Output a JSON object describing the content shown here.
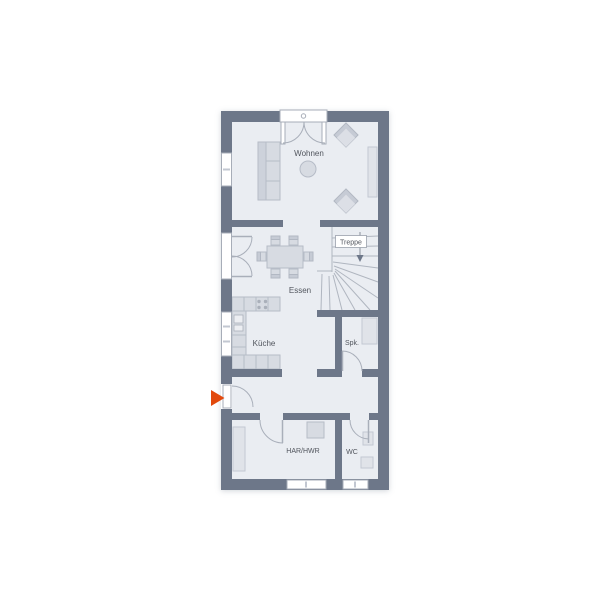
{
  "labels": {
    "wohnen": "Wohnen",
    "essen": "Essen",
    "treppe": "Treppe",
    "kueche": "Küche",
    "spk": "Spk.",
    "har_hwr": "HAR/HWR",
    "wc": "WC"
  },
  "colors": {
    "wall": "#6d7789",
    "floor": "#eaedf2",
    "furniture": "#d7dbe2",
    "entrance_arrow": "#e2490c",
    "background": "#ffffff"
  }
}
